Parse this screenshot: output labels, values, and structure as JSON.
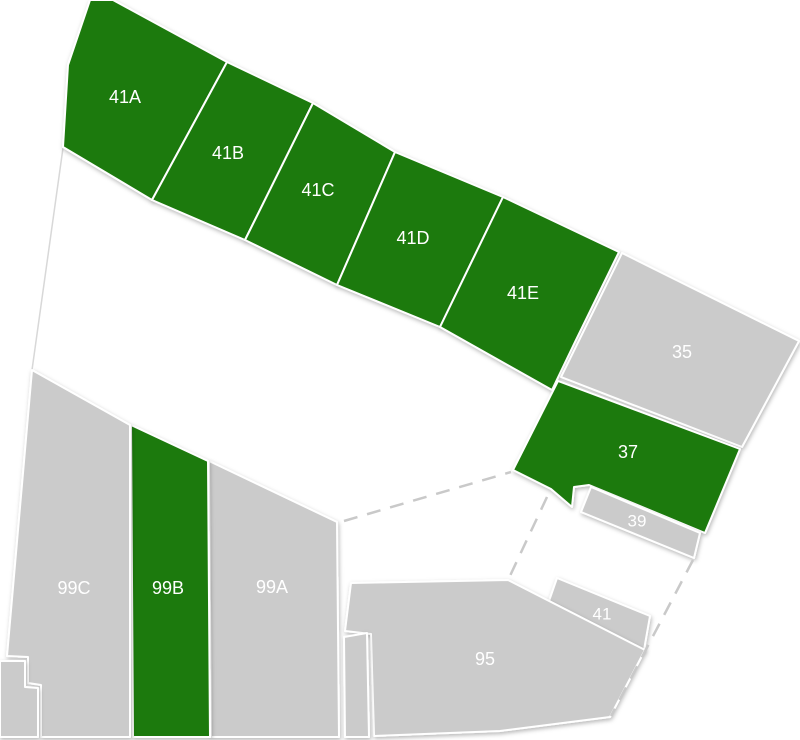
{
  "map": {
    "width": 800,
    "height": 740,
    "background": "#ffffff",
    "palette": {
      "highlight_fill": "#1e7a0f",
      "standard_fill": "#cbcbcb",
      "parcel_stroke": "#ffffff",
      "label_color": "#ffffff",
      "boundary_line_color": "#d8d8d8",
      "dashed_line_color": "#c9c9c9"
    },
    "parcels": [
      {
        "id": "41A",
        "label": "41A",
        "status": "highlighted",
        "points": "90,0 113,0 227,62 152,200 63,147 68,65",
        "label_x": 125,
        "label_y": 97,
        "font_size": 18
      },
      {
        "id": "41B",
        "label": "41B",
        "status": "highlighted",
        "points": "227,62 313,103 245,240 152,200",
        "label_x": 228,
        "label_y": 153,
        "font_size": 18
      },
      {
        "id": "41C",
        "label": "41C",
        "status": "highlighted",
        "points": "313,103 395,152 337,285 245,240",
        "label_x": 318,
        "label_y": 190,
        "font_size": 18
      },
      {
        "id": "41D",
        "label": "41D",
        "status": "highlighted",
        "points": "395,152 503,197 440,327 337,285",
        "label_x": 413,
        "label_y": 238,
        "font_size": 18
      },
      {
        "id": "41E",
        "label": "41E",
        "status": "highlighted",
        "points": "503,197 619,252 576,340 552,390 440,327",
        "label_x": 523,
        "label_y": 293,
        "font_size": 18
      },
      {
        "id": "35",
        "label": "35",
        "status": "standard",
        "points": "622,253 799,341 742,447 561,377",
        "label_x": 682,
        "label_y": 352,
        "font_size": 18
      },
      {
        "id": "37",
        "label": "37",
        "status": "highlighted",
        "points": "513,470 558,381 740,449 705,533 589,485 574,487 572,507 551,489",
        "label_x": 628,
        "label_y": 452,
        "font_size": 18
      },
      {
        "id": "39",
        "label": "39",
        "status": "standard",
        "points": "591,487 700,533 694,558 581,512",
        "label_x": 637,
        "label_y": 521,
        "font_size": 17
      },
      {
        "id": "41",
        "label": "41",
        "status": "standard",
        "points": "557,578 650,616 644,650 549,601",
        "label_x": 602,
        "label_y": 614,
        "font_size": 17
      },
      {
        "id": "95",
        "label": "95",
        "status": "standard",
        "points": "351,583 508,580 645,650 610,717 500,731 374,736 371,634 345,631",
        "label_x": 485,
        "label_y": 659,
        "font_size": 18
      },
      {
        "id": "99A",
        "label": "99A",
        "status": "standard",
        "points": "209,461 337,522 339,737 211,737",
        "label_x": 272,
        "label_y": 587,
        "font_size": 18
      },
      {
        "id": "99B",
        "label": "99B",
        "status": "highlighted",
        "points": "131,425 208,461 210,737 133,737",
        "label_x": 168,
        "label_y": 588,
        "font_size": 18
      },
      {
        "id": "99C",
        "label": "99C",
        "status": "standard",
        "points": "32,370 130,425 130,737 41,737 41,685 28,683 28,657 7,656",
        "label_x": 74,
        "label_y": 588,
        "font_size": 18
      },
      {
        "id": "",
        "label": "",
        "status": "standard",
        "points": "344,637 367,633 369,737 345,737",
        "label_x": 0,
        "label_y": 0,
        "font_size": 0
      },
      {
        "id": "",
        "label": "",
        "status": "standard",
        "points": "0,661 25,661 25,687 38,688 38,737 0,737",
        "label_x": 0,
        "label_y": 0,
        "font_size": 0
      }
    ],
    "boundary_lines": [
      {
        "x1": 63,
        "y1": 148,
        "x2": 32,
        "y2": 370
      }
    ],
    "dashed_lines": [
      {
        "x1": 344,
        "y1": 521,
        "x2": 511,
        "y2": 472
      },
      {
        "x1": 547,
        "y1": 497,
        "x2": 509,
        "y2": 578
      },
      {
        "x1": 693,
        "y1": 560,
        "x2": 611,
        "y2": 716
      }
    ]
  }
}
